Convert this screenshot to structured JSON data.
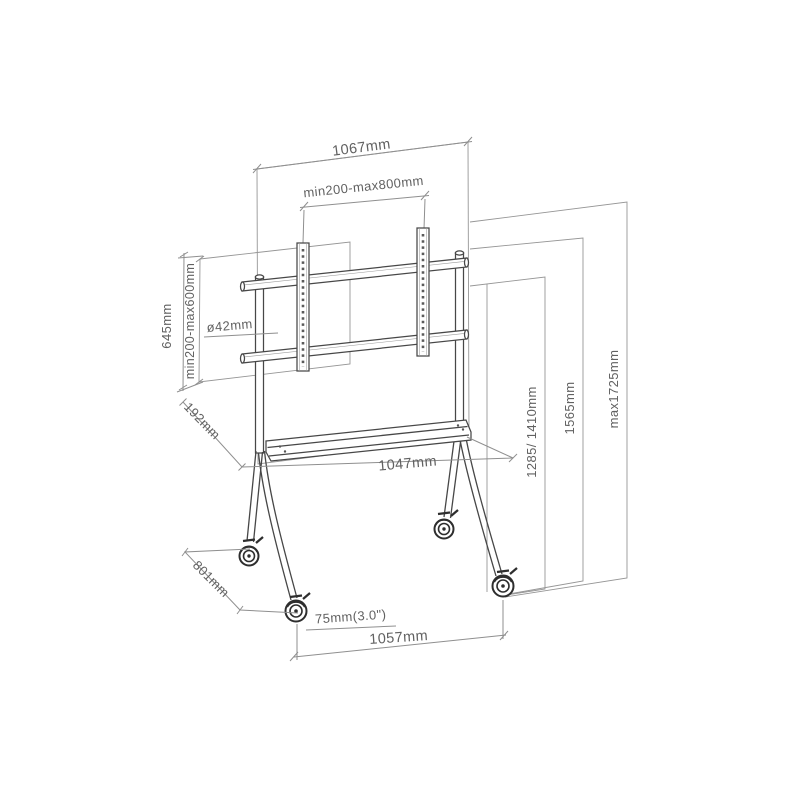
{
  "diagram": {
    "type": "technical-dimension-drawing",
    "subject": "mobile display floor stand with casters and shelf",
    "view": "isometric wireframe",
    "units": "mm"
  },
  "colors": {
    "background": "#ffffff",
    "structure_line": "#474747",
    "dimension_line": "#8f8f8f",
    "label_text": "#616161"
  },
  "labels": {
    "top_width": "1067mm",
    "vesa_width": "min200-max800mm",
    "bracket_height": "645mm",
    "vesa_height": "min200-max600mm",
    "pole_diameter": "ø42mm",
    "shelf_depth": "192mm",
    "shelf_width": "1047mm",
    "screen_center_height": "1285/ 1410mm",
    "mid_height": "1565mm",
    "max_height": "max1725mm",
    "base_depth": "801mm",
    "caster_diameter": "75mm(3.0\")",
    "base_width": "1057mm"
  }
}
